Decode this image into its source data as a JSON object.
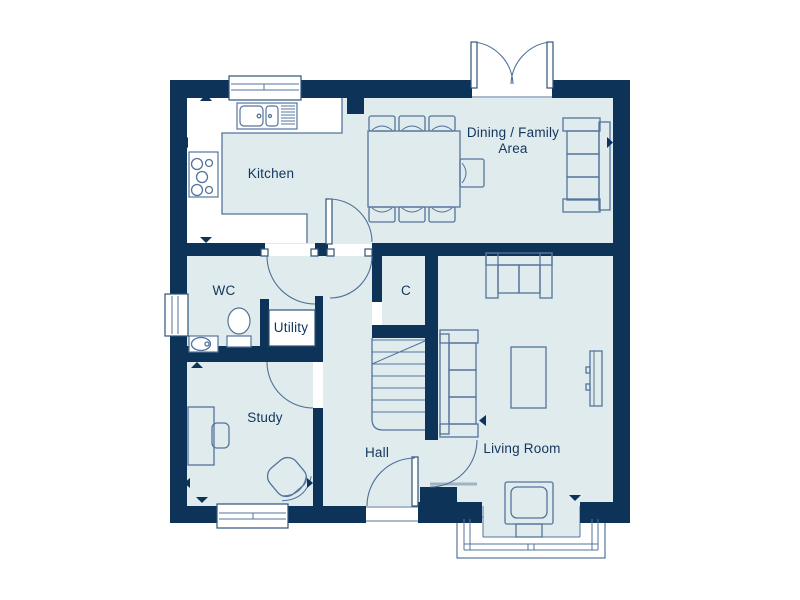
{
  "floorplan": {
    "rooms": {
      "kitchen": {
        "label": "Kitchen"
      },
      "dining": {
        "label_line1": "Dining / Family",
        "label_line2": "Area"
      },
      "wc": {
        "label": "WC"
      },
      "utility": {
        "label": "Utility"
      },
      "cupboard": {
        "label": "C"
      },
      "study": {
        "label": "Study"
      },
      "hall": {
        "label": "Hall"
      },
      "living": {
        "label": "Living Room"
      }
    },
    "colors": {
      "wall": "#0e3359",
      "floor": "#e0ebee",
      "furniture_line": "#54749c",
      "label_text": "#12355c",
      "background": "#ffffff"
    }
  }
}
